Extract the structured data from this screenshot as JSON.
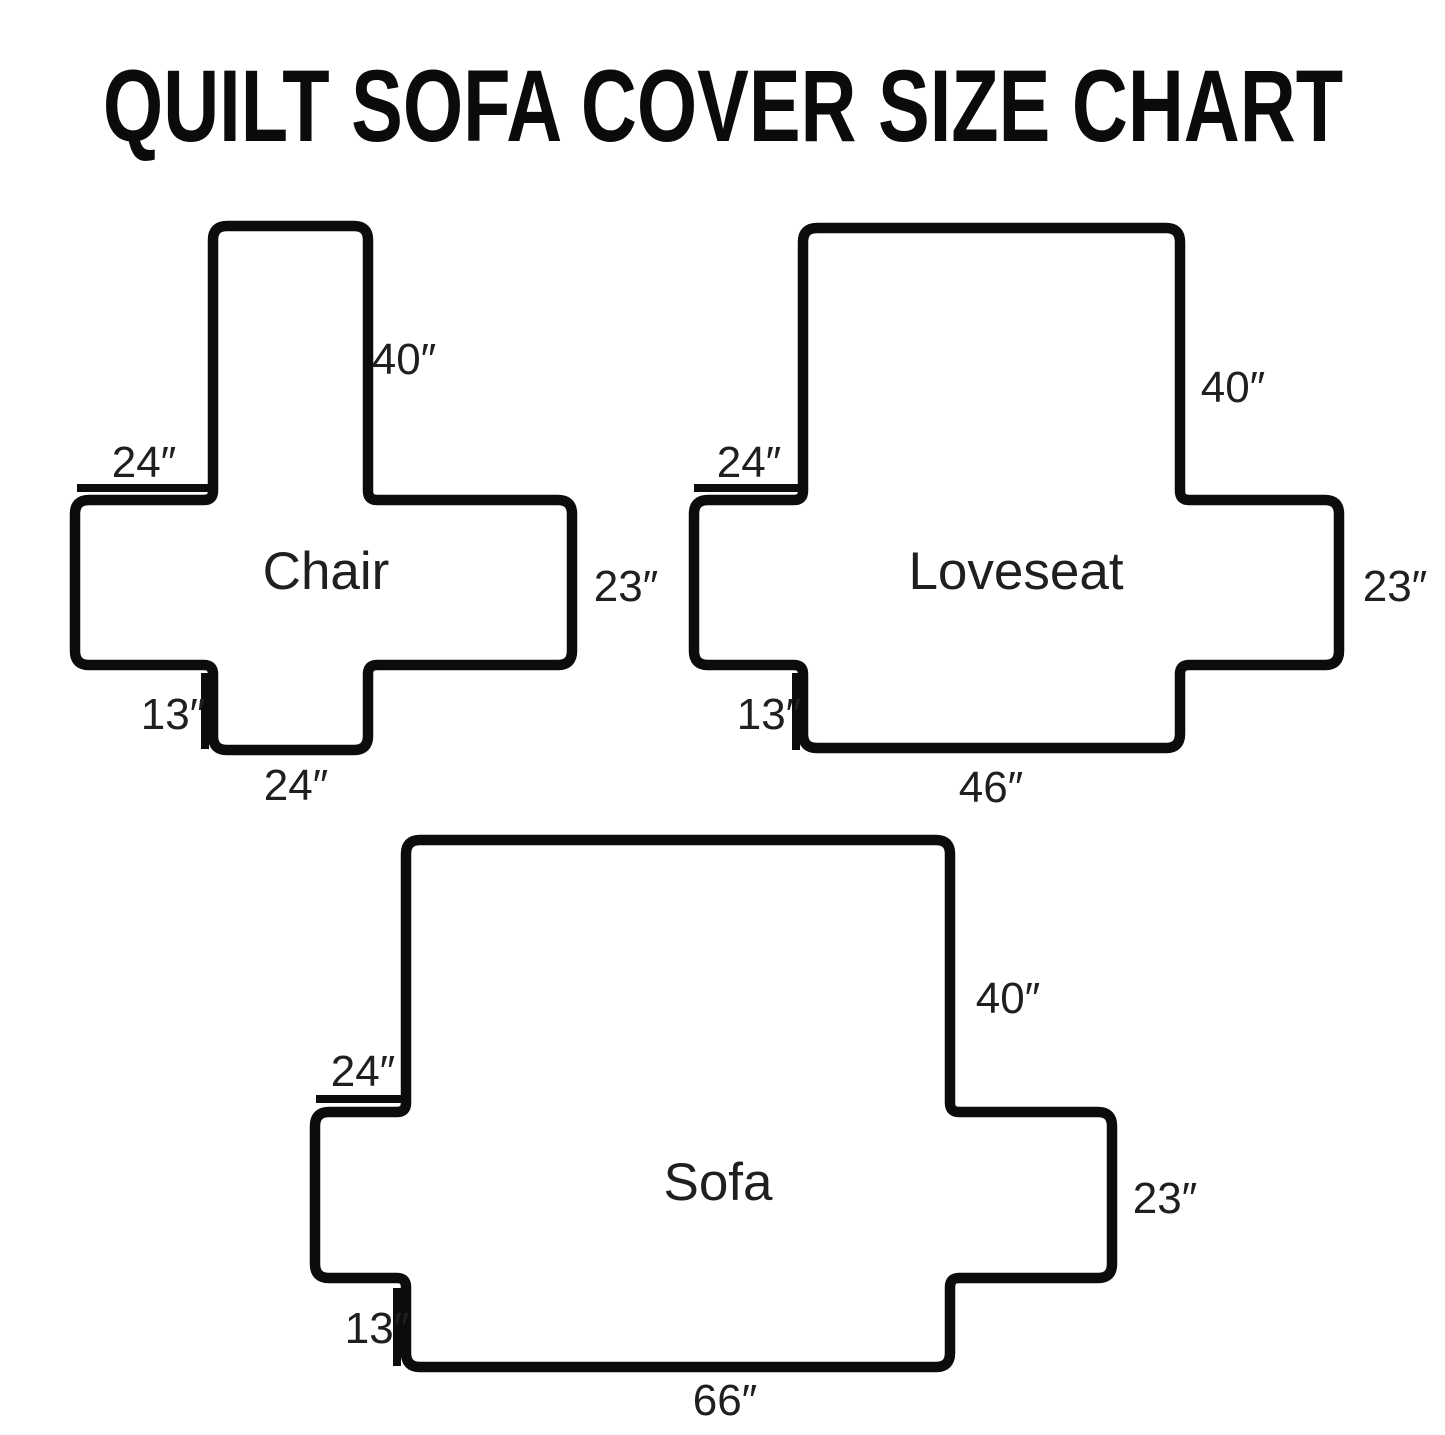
{
  "page": {
    "title": "QUILT SOFA COVER SIZE CHART",
    "background_color": "#ffffff",
    "outline_color": "#0c0c0c",
    "text_color": "#1f1f1f"
  },
  "diagrams": [
    {
      "name": "Chair",
      "back_length": "40″",
      "arm_width": "24″",
      "side_height": "23″",
      "skirt_height": "13″",
      "front_width": "24″"
    },
    {
      "name": "Loveseat",
      "back_length": "40″",
      "arm_width": "24″",
      "side_height": "23″",
      "skirt_height": "13″",
      "front_width": "46″"
    },
    {
      "name": "Sofa",
      "back_length": "40″",
      "arm_width": "24″",
      "side_height": "23″",
      "skirt_height": "13″",
      "front_width": "66″"
    }
  ]
}
